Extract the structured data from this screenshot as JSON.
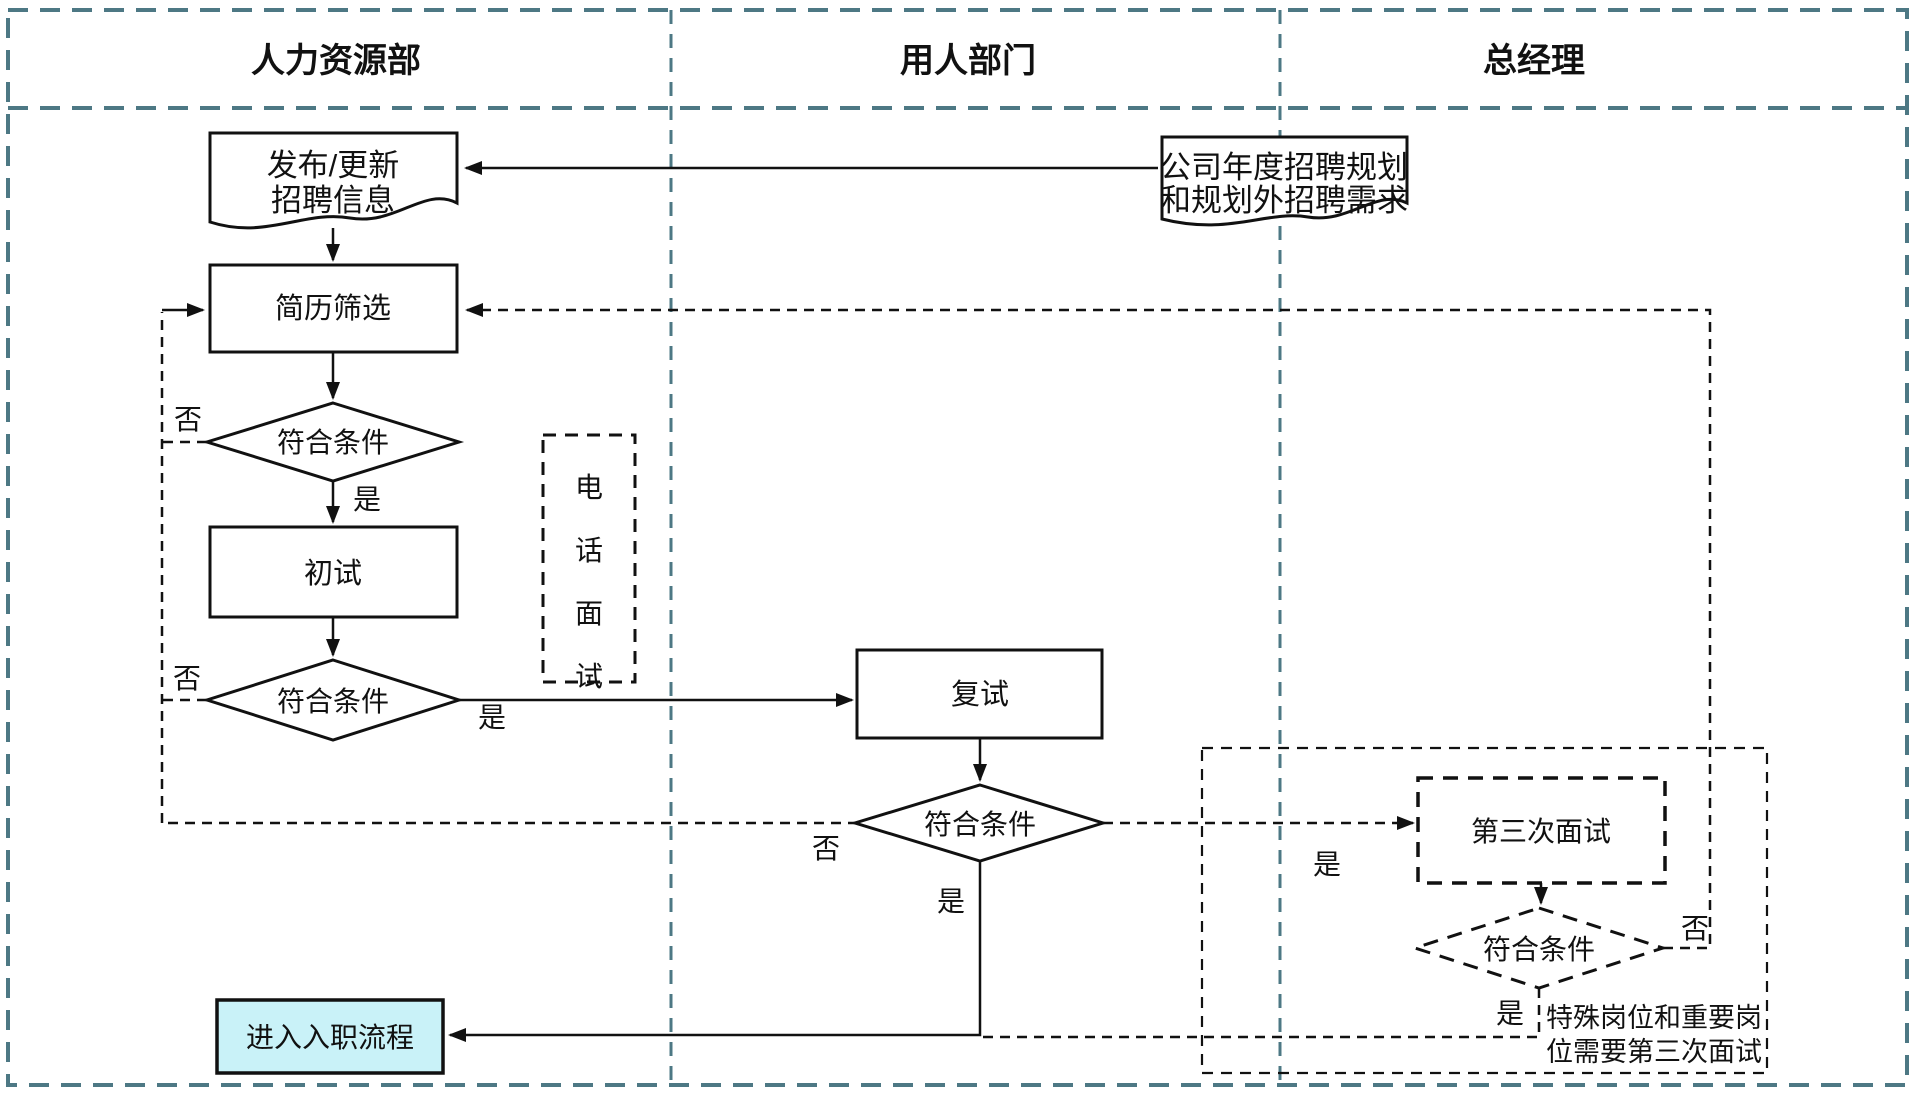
{
  "header": {
    "lane1": "人力资源部",
    "lane2": "用人部门",
    "lane3": "总经理"
  },
  "nodes": {
    "publish_update": {
      "line1": "发布/更新",
      "line2": "招聘信息"
    },
    "annual_plan": {
      "line1": "公司年度招聘规划",
      "line2": "和规划外招聘需求"
    },
    "resume_screening": "简历筛选",
    "screening_decision": "符合条件",
    "first_interview": "初试",
    "first_decision": "符合条件",
    "phone_interview": [
      "电",
      "话",
      "面",
      "试"
    ],
    "second_interview": "复试",
    "second_decision": "符合条件",
    "third_interview": "第三次面试",
    "third_decision": "符合条件",
    "onboarding": "进入入职流程"
  },
  "labels": {
    "yes": "是",
    "no": "否"
  },
  "annotation": {
    "line1": "特殊岗位和重要岗",
    "line2": "位需要第三次面试"
  },
  "colors": {
    "lane_border": "#4d7884",
    "connector_black": "#111111",
    "onboarding_fill": "#c9f2f8",
    "annotation_red": "#cd3a12"
  }
}
